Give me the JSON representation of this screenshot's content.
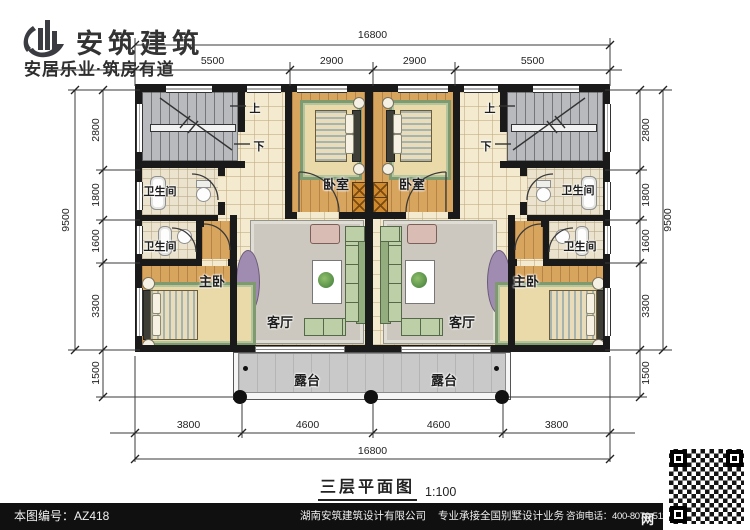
{
  "header": {
    "brand": "安筑建筑",
    "slogan": "安居乐业·筑房有道"
  },
  "dims": {
    "top_total": "16800",
    "top_segments": [
      "5500",
      "2900",
      "2900",
      "5500"
    ],
    "bottom_segments": [
      "3800",
      "4600",
      "4600",
      "3800"
    ],
    "bottom_total": "16800",
    "side_total": "9500",
    "side_segments": [
      "2800",
      "1800",
      "1600",
      "3300"
    ],
    "side_bottom": "1500"
  },
  "rooms": {
    "bedroom": "卧室",
    "bathroom": "卫生间",
    "master_bedroom": "主卧",
    "living_room": "客厅",
    "terrace": "露台",
    "stair_up": "上",
    "stair_down": "下"
  },
  "plan_title": {
    "name": "三层平面图",
    "scale": "1:100"
  },
  "footer": {
    "drawing_no": "本图编号：AZ418",
    "company": "湖南安筑建筑设计有限公司",
    "service": "专业承接全国别墅设计业务",
    "phone": "咨询电话：400-8070-511",
    "net": "网"
  },
  "watermark": {
    "text": "安筑建筑"
  },
  "colors": {
    "wall": "#1a1a1a",
    "wood_floor": "#d8a55f",
    "tile_floor": "#f3ead0",
    "stair_gray": "#b9babe",
    "terrace_gray": "#c9c9c9",
    "wardrobe_orange": "#d08a2e",
    "rug_green": "#7f9a6e",
    "brand": "#3b3b42",
    "footer_bg": "#101010"
  }
}
